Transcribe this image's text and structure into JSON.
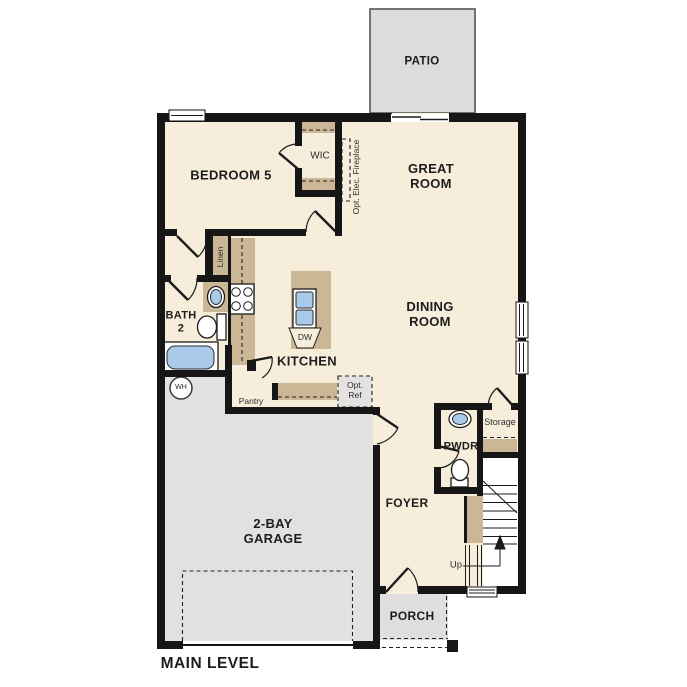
{
  "plan": {
    "title": "MAIN LEVEL",
    "labels": {
      "patio": "PATIO",
      "bedroom5": "BEDROOM 5",
      "wic": "WIC",
      "fireplace": "Opt. Elec. Fireplace",
      "great_room": "GREAT\nROOM",
      "dining_room": "DINING\nROOM",
      "kitchen": "KITCHEN",
      "bath2": "BATH\n2",
      "linen": "Linen",
      "water_heater": "WH",
      "pantry": "Pantry",
      "opt_ref": "Opt.\nRef",
      "dishwasher": "DW",
      "garage": "2-BAY\nGARAGE",
      "foyer": "FOYER",
      "pwdr": "PWDR",
      "storage": "Storage",
      "up": "Up",
      "porch": "PORCH"
    },
    "colors": {
      "wall": "#161616",
      "floor": "#f6eedb",
      "garage": "#e2e1e0",
      "patio": "#dcdcdc",
      "porch": "#e0dfde",
      "cabinet": "#cbb795",
      "fixture": "#a9cbe9"
    }
  }
}
